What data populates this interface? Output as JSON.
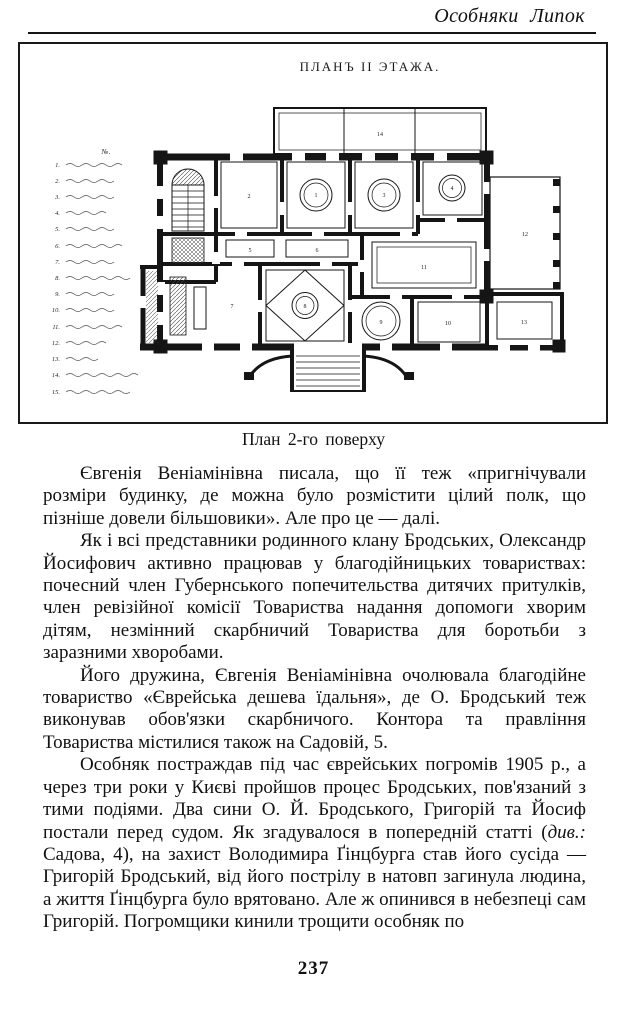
{
  "page": {
    "header_title": "Особняки Липок",
    "page_number": "237"
  },
  "figure": {
    "plan_title": "ПЛАНЪ II ЭТАЖА.",
    "caption": "План 2-го поверху",
    "legend_heading": "№.",
    "legend_numbers": [
      "1.",
      "2.",
      "3.",
      "4.",
      "5.",
      "6.",
      "7.",
      "8.",
      "9.",
      "10.",
      "11.",
      "12.",
      "13.",
      "14.",
      "15."
    ],
    "room_numbers": {
      "terrace": "14",
      "stairs": "15",
      "room2": "2",
      "room_a": "1",
      "room_b": "3",
      "room_c": "4",
      "corridor1": "5",
      "corridor2": "6",
      "room_left": "7",
      "room_diamond": "8",
      "room_stove": "9",
      "room_10": "10",
      "hall": "11",
      "veranda": "12",
      "room_13": "13"
    }
  },
  "body": {
    "p1": "Євгенія Веніамінівна писала, що її теж «пригнічували розміри будинку, де можна було розмістити цілий полк, що пізніше довели більшовики». Але про це — далі.",
    "p2": "Як і всі представники родинного клану Бродських, Олександр Йосифович активно працював у благодійницьких товариствах: почесний член Губернського попечительства дитячих притулків, член ревізійної комісії Товариства надання допомоги хворим дітям, незмінний скарбничий Товариства для боротьби з заразними хворобами.",
    "p3": "Його дружина, Євгенія Веніамінівна очолювала благодійне товариство «Єврейська дешева їдальня», де О. Бродський теж виконував обов'язки скарбничого. Контора та правління Товариства містилися також на Садовій, 5.",
    "p4_before": "Особняк постраждав під час єврейських погромів 1905 р., а через три роки у Києві пройшов процес Бродських, пов'язаний з тими подіями. Два сини О. Й. Бродського, Григорій та Йосиф постали перед судом. Як згадувалося в попередній статті (",
    "p4_italic": "див.:",
    "p4_after": " Садова, 4), на захист Володимира Ґінцбурга став його сусіда — Григорій Бродський, від його пострілу в натовп загинула людина, а життя Ґінцбурга було врятовано. Але ж опинився в небезпеці сам Григорій. Погромщики кинили трощити особняк по"
  }
}
